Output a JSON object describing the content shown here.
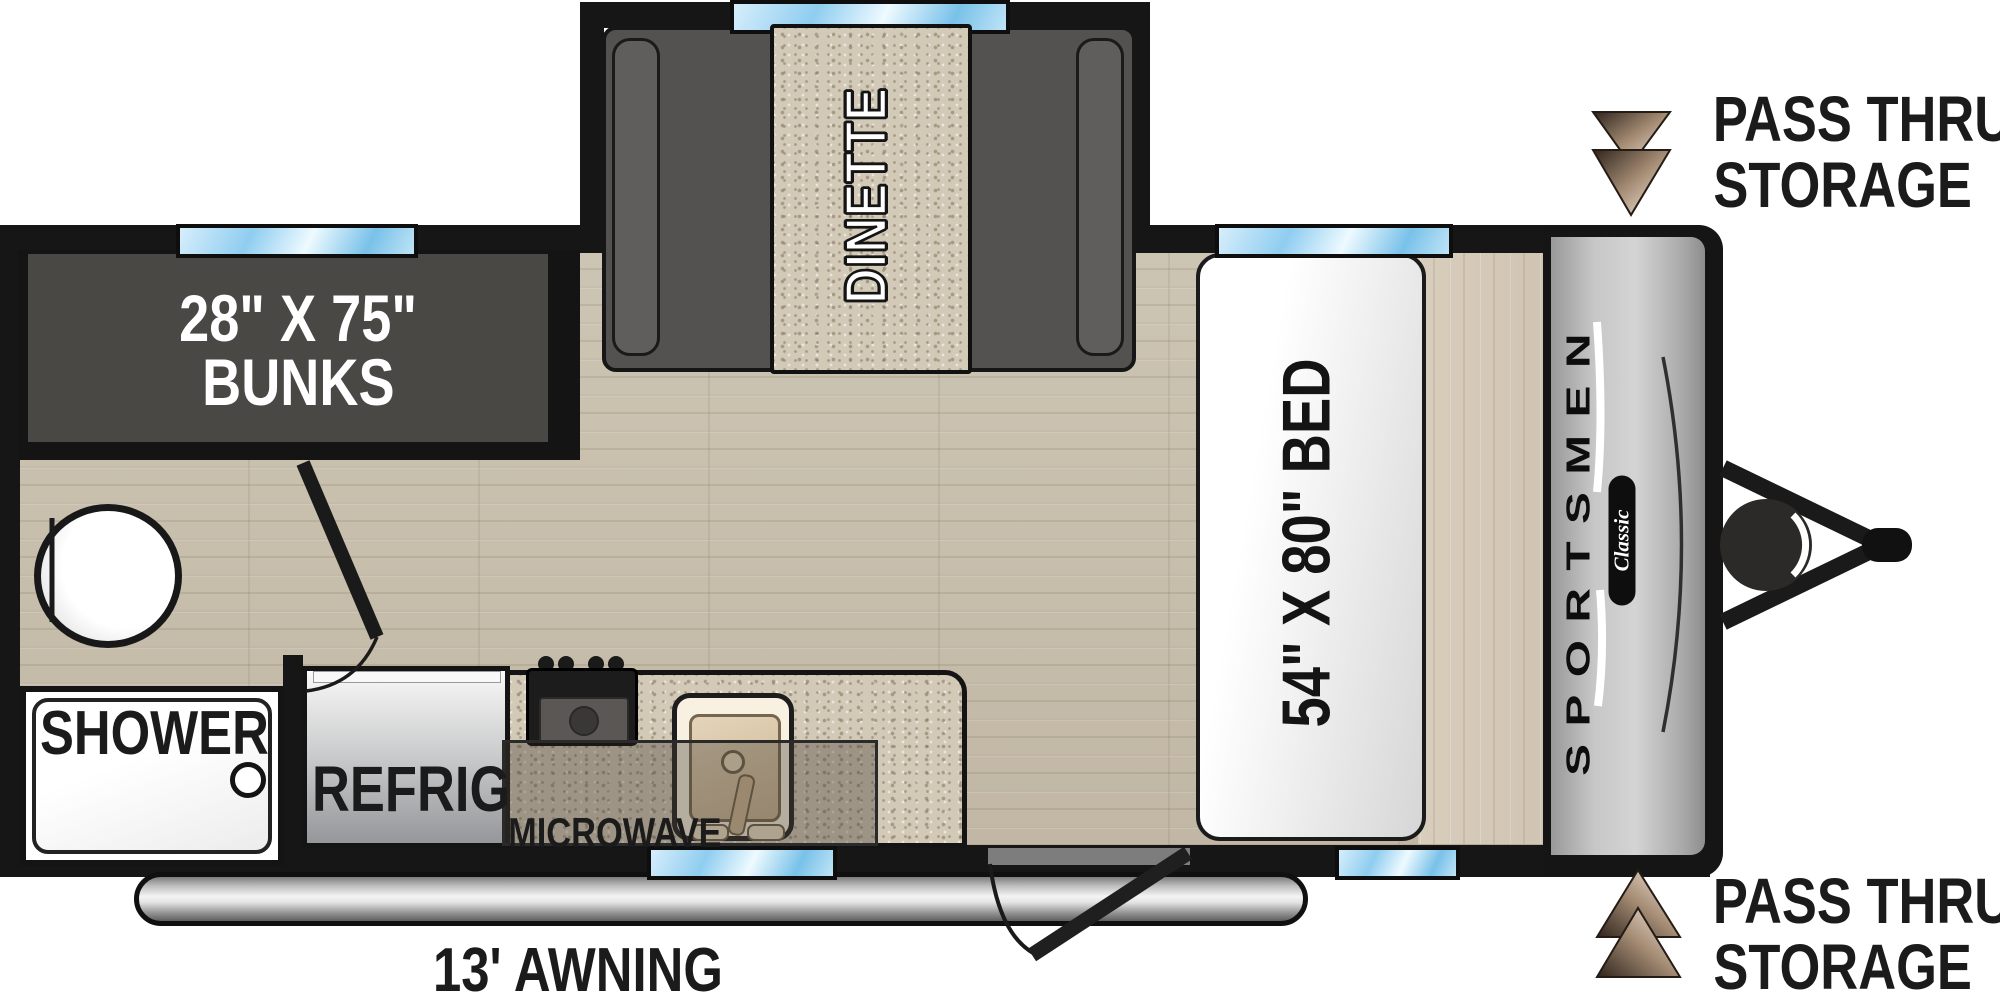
{
  "plan": {
    "bunks_label_line1": "28\" X 75\"",
    "bunks_label_line2": "BUNKS",
    "dinette_label": "DINETTE",
    "bed_label": "54\" X 80\" BED",
    "shower_label": "SHOWER",
    "refrig_label": "REFRIG",
    "microwave_label": "MICROWAVE",
    "awning_label": "13' AWNING",
    "pass_thru_top_line1": "PASS THRU",
    "pass_thru_top_line2": "STORAGE",
    "pass_thru_bottom_line1": "PASS THRU",
    "pass_thru_bottom_line2": "STORAGE",
    "brand_name": "SPORTSMEN",
    "brand_series": "Classic"
  },
  "colors": {
    "wall": "#161616",
    "window_glass": "#8fcdf0",
    "bunk_area": "#4a4845",
    "bench_gray": "#535251",
    "floor_wood": "#c8bfad",
    "granite": "#d2c9b7",
    "front_cap_gray": "#c6c6c6",
    "arrow_tan": "#c6ac93",
    "label_black": "#1b1b1b"
  }
}
